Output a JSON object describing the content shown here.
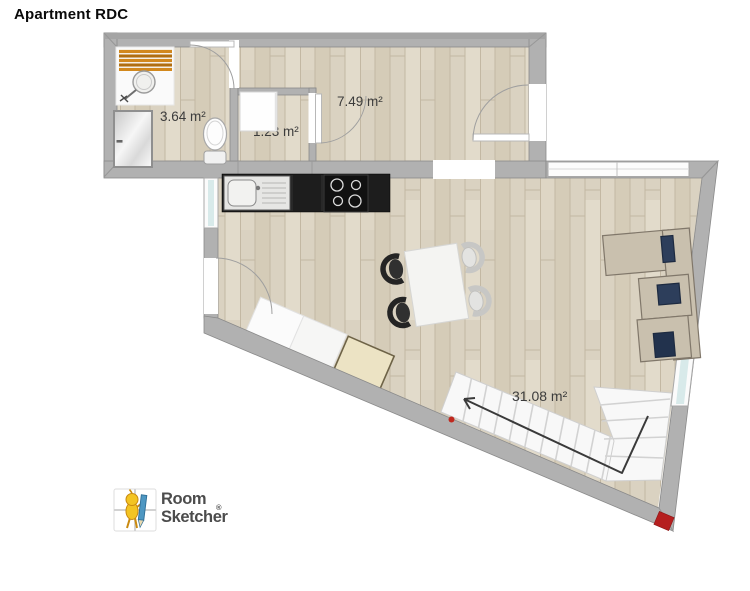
{
  "title": "Apartment RDC",
  "plan": {
    "room_areas": [
      "3.64 m²",
      "1.23 m²",
      "7.49 m²",
      "31.08 m²"
    ]
  },
  "branding": {
    "logo_line1": "Room",
    "logo_line2": "Sketcher",
    "registered_mark": "®"
  },
  "colors": {
    "floor_wood": "#dad2c1",
    "wall_gray": "#b1b1b1",
    "counter_black": "#1d1d1d",
    "sofa_beige": "#c9c0ae",
    "cushion_navy": "#2d3e5b",
    "marker_red": "#c0281e",
    "window_glass": "#d8eaea",
    "mat_orange": "#d2881c"
  }
}
